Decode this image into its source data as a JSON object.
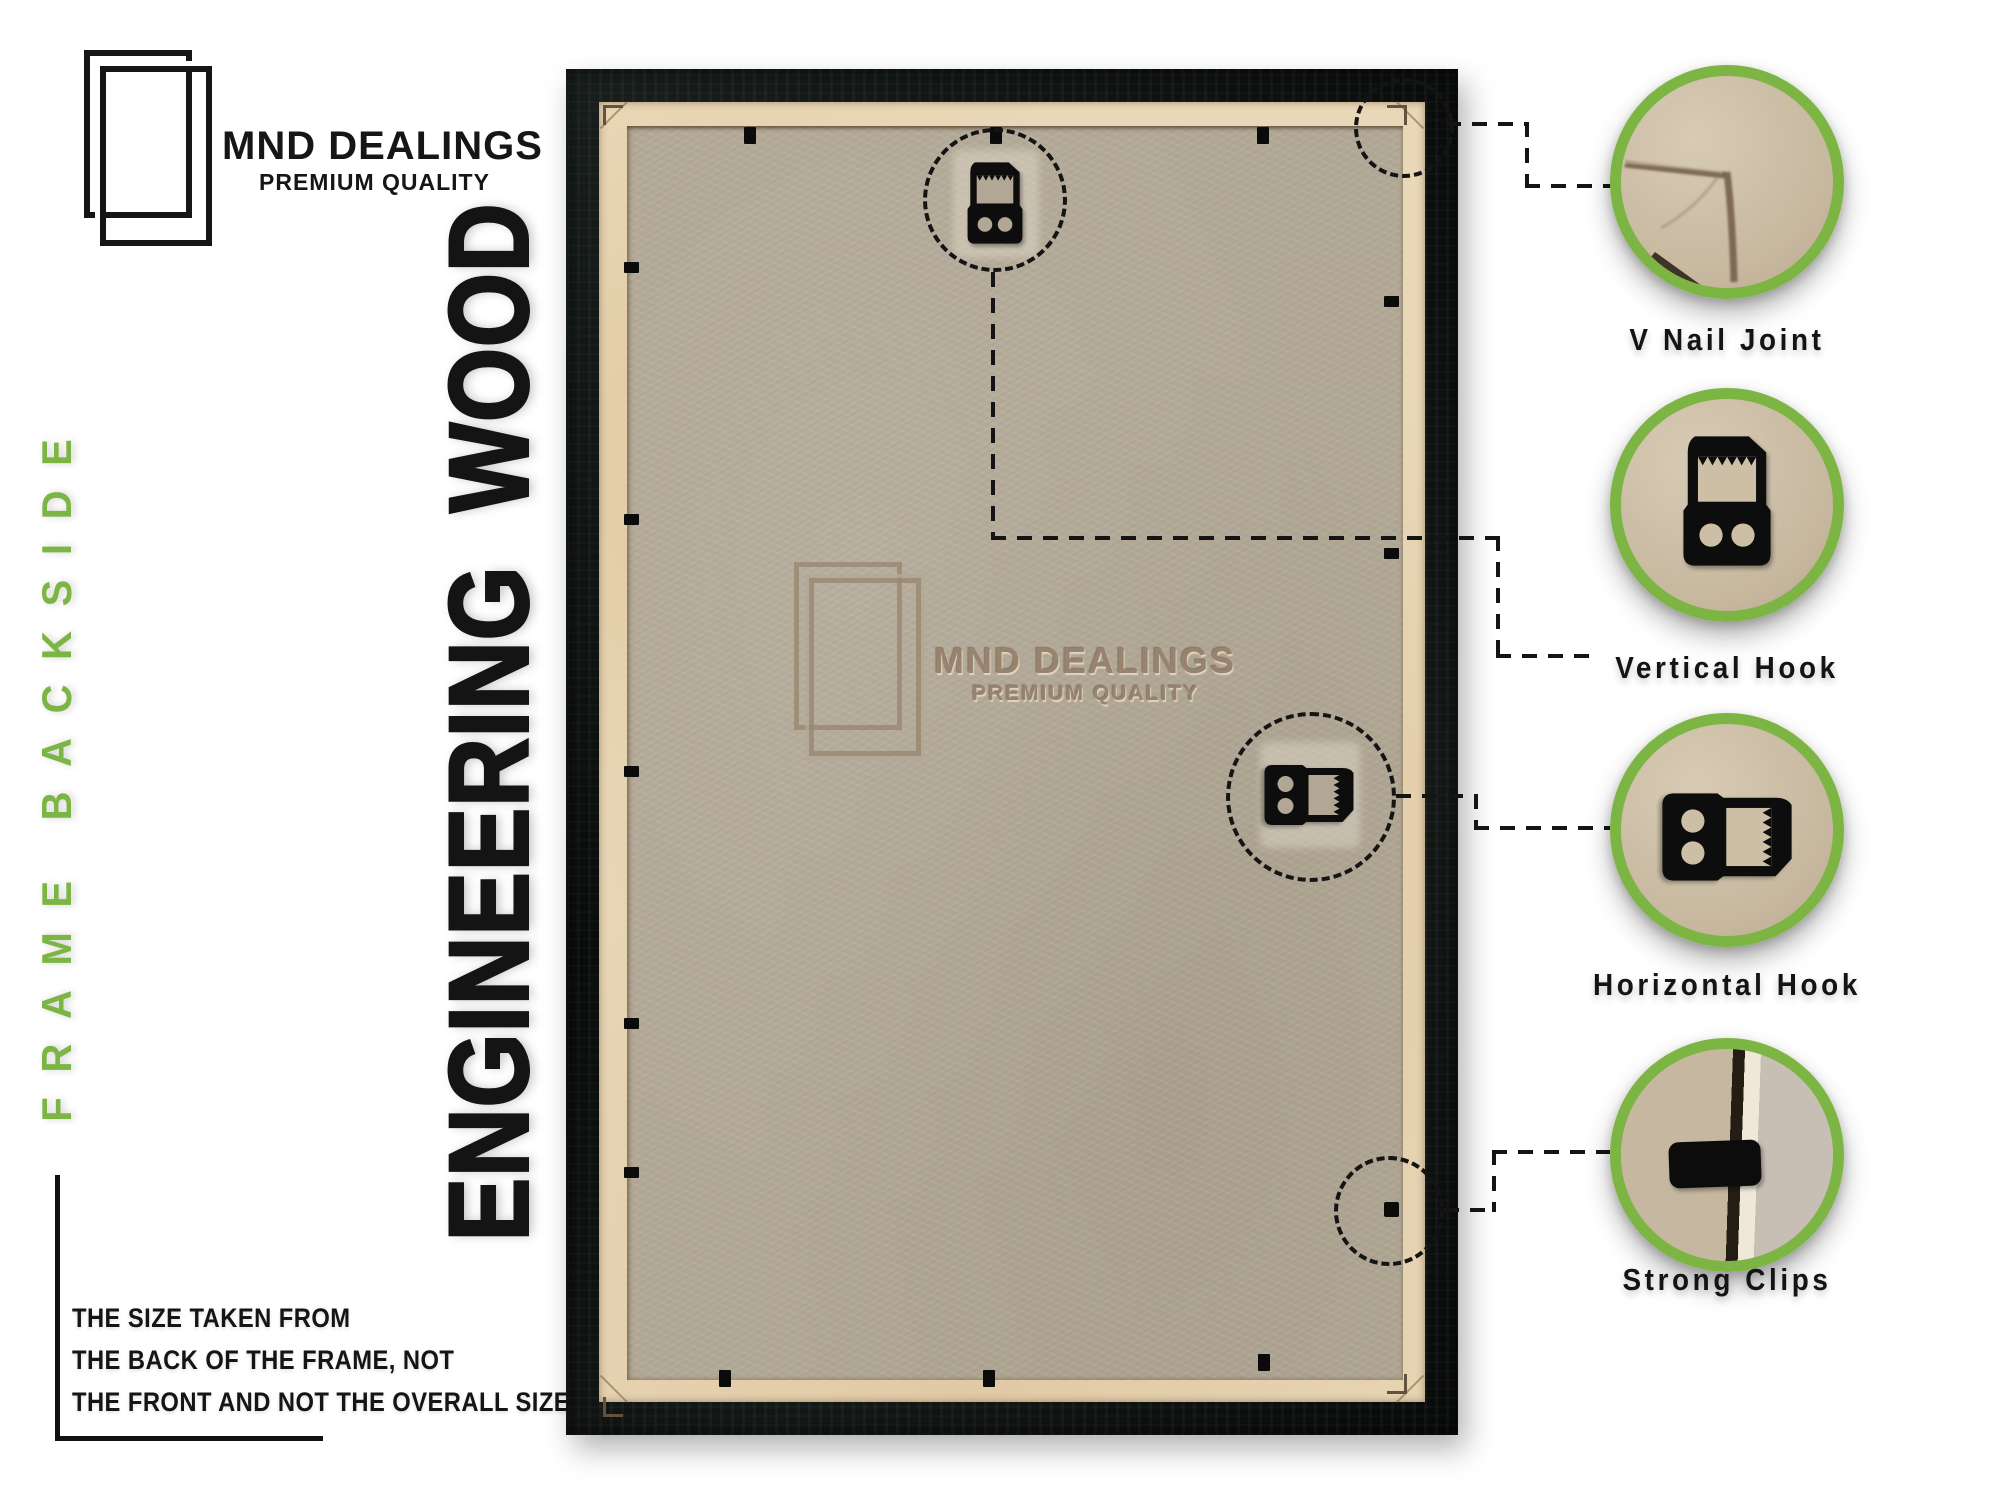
{
  "brand": {
    "name": "MND DEALINGS",
    "tagline": "PREMIUM QUALITY"
  },
  "side_label": "FRAME BACKSIDE",
  "material_title": "ENGINEERING WOOD",
  "watermark": {
    "name": "MND DEALINGS",
    "tagline": "PREMIUM QUALITY"
  },
  "size_note": {
    "lines": [
      "THE SIZE TAKEN FROM",
      "THE BACK OF THE FRAME, NOT",
      "THE FRONT AND NOT THE OVERALL SIZE."
    ]
  },
  "callouts": [
    {
      "label": "V Nail Joint",
      "icon": "v-nail-joint-photo"
    },
    {
      "label": "Vertical Hook",
      "icon": "vertical-hook-photo"
    },
    {
      "label": "Horizontal Hook",
      "icon": "horizontal-hook-photo"
    },
    {
      "label": "Strong Clips",
      "icon": "strong-clip-photo"
    }
  ],
  "colors": {
    "accent_green": "#7cb544",
    "frame_black": "#0d100f",
    "paper_tan": "#e9d8b8",
    "board_tan": "#b2a896",
    "text_black": "#141414",
    "watermark_brown": "#95806a"
  }
}
